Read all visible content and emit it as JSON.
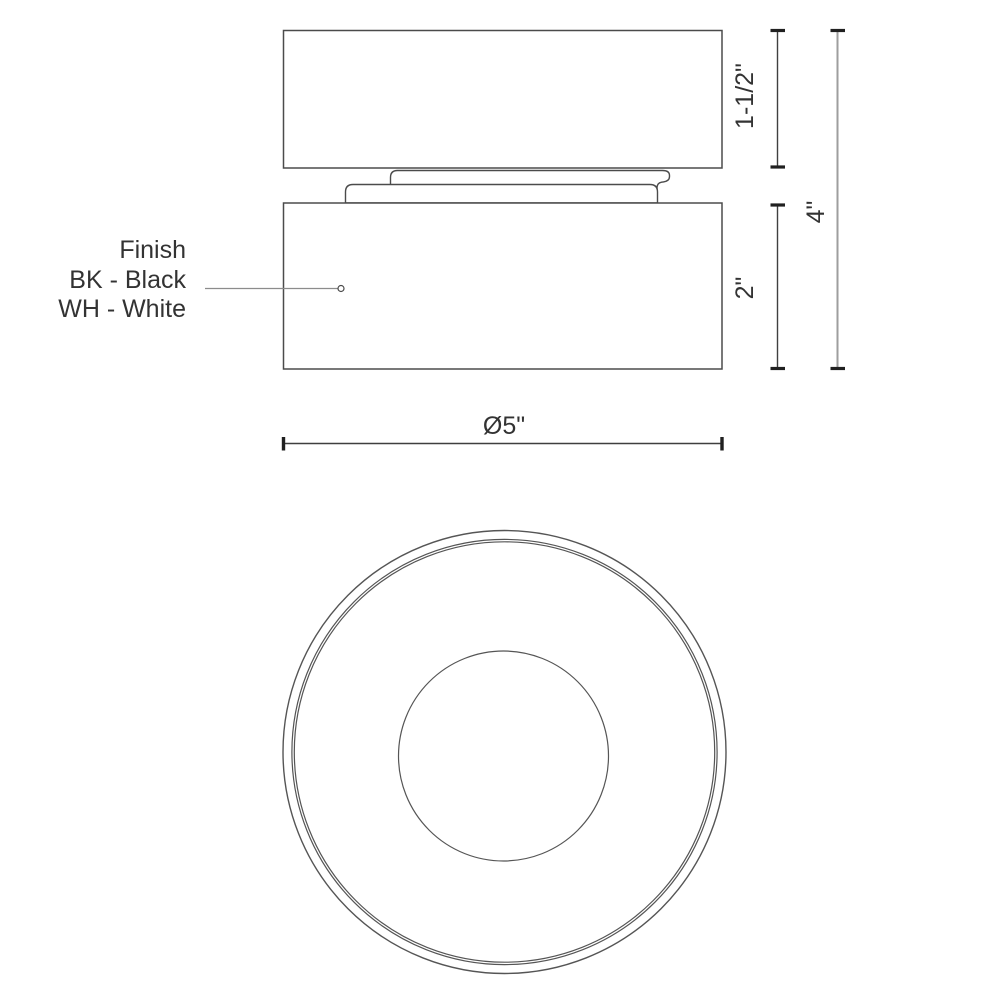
{
  "finish": {
    "title": "Finish",
    "options": [
      "BK - Black",
      "WH - White"
    ]
  },
  "dimensions": {
    "canopy_height": "1-1/2\"",
    "body_height": "2\"",
    "overall_height": "4\"",
    "diameter": "Ø5\""
  },
  "colors": {
    "outline": "#4b4b4b",
    "dim_line": "#3f3f3f",
    "overall_dim_line": "#9e9e9e",
    "tick": "#202020",
    "leader": "#8c8c8c",
    "text": "#333333"
  }
}
